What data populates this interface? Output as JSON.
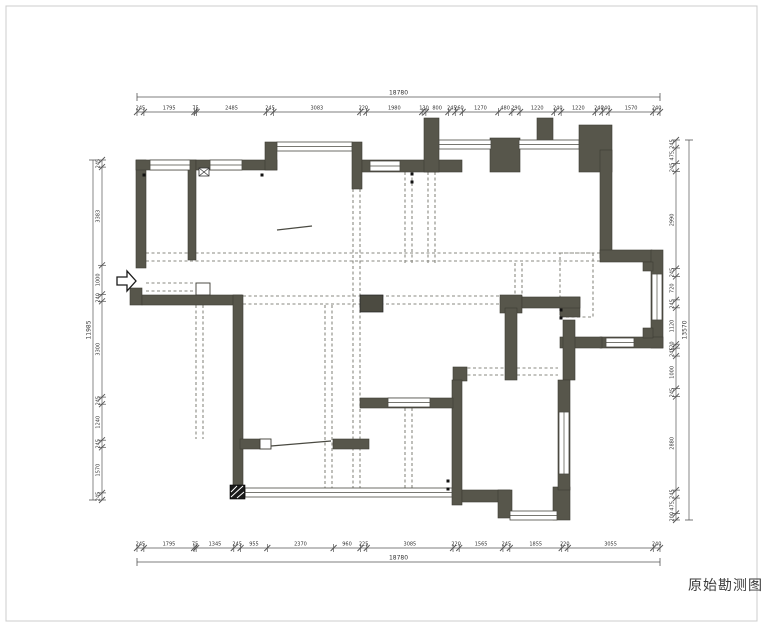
{
  "title": {
    "label": "原始勘测图"
  },
  "colors": {
    "wall": "#57564b",
    "wall_stroke": "#3c3b33",
    "window_fill": "#ffffff",
    "window_stroke": "#4a4a42",
    "dashed": "#8a8a82",
    "dim_line": "#555555",
    "dim_text": "#333333",
    "frame": "#cccccc",
    "column": "#4c4b41",
    "hatch": "#1a1a1a"
  },
  "dimensions": {
    "top": {
      "total": "18780",
      "segments": [
        "245",
        "1795",
        "75",
        "2485",
        "245",
        "3083",
        "220",
        "1980",
        "130",
        "800",
        "245",
        "260",
        "1270",
        "480",
        "290",
        "1220",
        "240",
        "1220",
        "240",
        "240",
        "1570",
        "240"
      ],
      "x0": 137,
      "x1": 660,
      "line_y": 112,
      "total_y": 97
    },
    "bottom": {
      "total": "18780",
      "segments": [
        "245",
        "1795",
        "75",
        "1345",
        "245",
        "955",
        "2370",
        "960",
        "225",
        "3085",
        "220",
        "1565",
        "245",
        "1855",
        "220",
        "3055",
        "240"
      ],
      "x0": 137,
      "x1": 660,
      "line_y": 548,
      "total_y": 562
    },
    "left": {
      "total": "11985",
      "segments": [
        "245",
        "3383",
        "1000",
        "240",
        "3300",
        "245",
        "1240",
        "245",
        "1570",
        "245"
      ],
      "y0": 160,
      "y1": 500,
      "line_x": 102,
      "total_x": 93
    },
    "right": {
      "total": "13570",
      "segments": [
        "245",
        "475",
        "245",
        "2990",
        "245",
        "720",
        "245",
        "1120",
        "120",
        "245",
        "1000",
        "245",
        "2880",
        "245",
        "475",
        "200"
      ],
      "y0": 140,
      "y1": 520,
      "line_x": 676,
      "total_x": 689
    }
  },
  "plan": {
    "walls": [
      [
        136,
        160,
        10,
        108
      ],
      [
        130,
        288,
        12,
        17
      ],
      [
        142,
        295,
        100,
        10
      ],
      [
        233,
        295,
        10,
        196
      ],
      [
        136,
        160,
        60,
        10
      ],
      [
        188,
        160,
        8,
        100
      ],
      [
        196,
        160,
        81,
        10
      ],
      [
        265,
        142,
        12,
        28
      ],
      [
        352,
        142,
        10,
        47
      ],
      [
        362,
        160,
        100,
        12
      ],
      [
        424,
        118,
        15,
        54
      ],
      [
        490,
        138,
        30,
        34
      ],
      [
        537,
        118,
        16,
        26
      ],
      [
        579,
        125,
        33,
        47
      ],
      [
        600,
        150,
        12,
        108
      ],
      [
        600,
        250,
        52,
        12
      ],
      [
        651,
        250,
        12,
        98
      ],
      [
        600,
        337,
        63,
        11
      ],
      [
        560,
        337,
        42,
        11
      ],
      [
        560,
        297,
        20,
        20
      ],
      [
        500,
        295,
        22,
        18
      ],
      [
        522,
        297,
        58,
        11
      ],
      [
        505,
        308,
        12,
        72
      ],
      [
        563,
        320,
        12,
        60
      ],
      [
        453,
        367,
        14,
        14
      ],
      [
        452,
        380,
        10,
        125
      ],
      [
        462,
        490,
        48,
        12
      ],
      [
        498,
        490,
        14,
        28
      ],
      [
        553,
        487,
        17,
        33
      ],
      [
        558,
        380,
        12,
        110
      ],
      [
        360,
        398,
        93,
        10
      ],
      [
        240,
        439,
        20,
        10
      ],
      [
        333,
        439,
        36,
        10
      ],
      [
        643,
        262,
        10,
        9
      ],
      [
        643,
        328,
        10,
        10
      ]
    ],
    "windows": [
      [
        150,
        160,
        40,
        10
      ],
      [
        210,
        160,
        32,
        10
      ],
      [
        370,
        161,
        30,
        10
      ],
      [
        277,
        142,
        75,
        9
      ],
      [
        439,
        140,
        52,
        9
      ],
      [
        519,
        140,
        60,
        9
      ],
      [
        652,
        274,
        10,
        46
      ],
      [
        606,
        338,
        28,
        9
      ],
      [
        388,
        398,
        42,
        9
      ],
      [
        559,
        412,
        10,
        62
      ],
      [
        245,
        488,
        207,
        9
      ],
      [
        510,
        511,
        47,
        9
      ]
    ],
    "white_boxes": [
      [
        260,
        439,
        11,
        10
      ],
      [
        196,
        283,
        14,
        12
      ]
    ],
    "dashed_h": [
      [
        146,
        600,
        253
      ],
      [
        146,
        600,
        261
      ],
      [
        243,
        505,
        296
      ],
      [
        243,
        505,
        304
      ],
      [
        146,
        196,
        283
      ],
      [
        146,
        196,
        291
      ],
      [
        462,
        558,
        368
      ],
      [
        462,
        558,
        375
      ]
    ],
    "dashed_v": [
      [
        196,
        305,
        439
      ],
      [
        203,
        305,
        439
      ],
      [
        325,
        305,
        488
      ],
      [
        332,
        305,
        488
      ],
      [
        353,
        189,
        488
      ],
      [
        360,
        189,
        488
      ],
      [
        405,
        172,
        263
      ],
      [
        412,
        172,
        263
      ],
      [
        428,
        172,
        263
      ],
      [
        435,
        172,
        263
      ],
      [
        405,
        408,
        489
      ],
      [
        412,
        408,
        489
      ],
      [
        515,
        263,
        297
      ],
      [
        522,
        263,
        297
      ]
    ],
    "dashed_box": [
      560,
      253,
      33,
      64
    ],
    "columns": [
      [
        360,
        295,
        23,
        17
      ]
    ],
    "hatch_column": [
      230,
      485,
      15,
      14
    ],
    "hinge_dots": [
      [
        144,
        175
      ],
      [
        262,
        175
      ],
      [
        412,
        174
      ],
      [
        412,
        182
      ],
      [
        561,
        310
      ],
      [
        561,
        318
      ],
      [
        448,
        481
      ],
      [
        448,
        489
      ]
    ],
    "door_leaves": [
      [
        271,
        446,
        331,
        441
      ],
      [
        277,
        230,
        312,
        226
      ]
    ],
    "door_x_icon": [
      199,
      168,
      10,
      8
    ],
    "entry_arrow": "117,277 127,277 127,271 136,281 127,291 127,285 117,285",
    "frame": [
      6,
      6,
      751,
      615
    ]
  }
}
